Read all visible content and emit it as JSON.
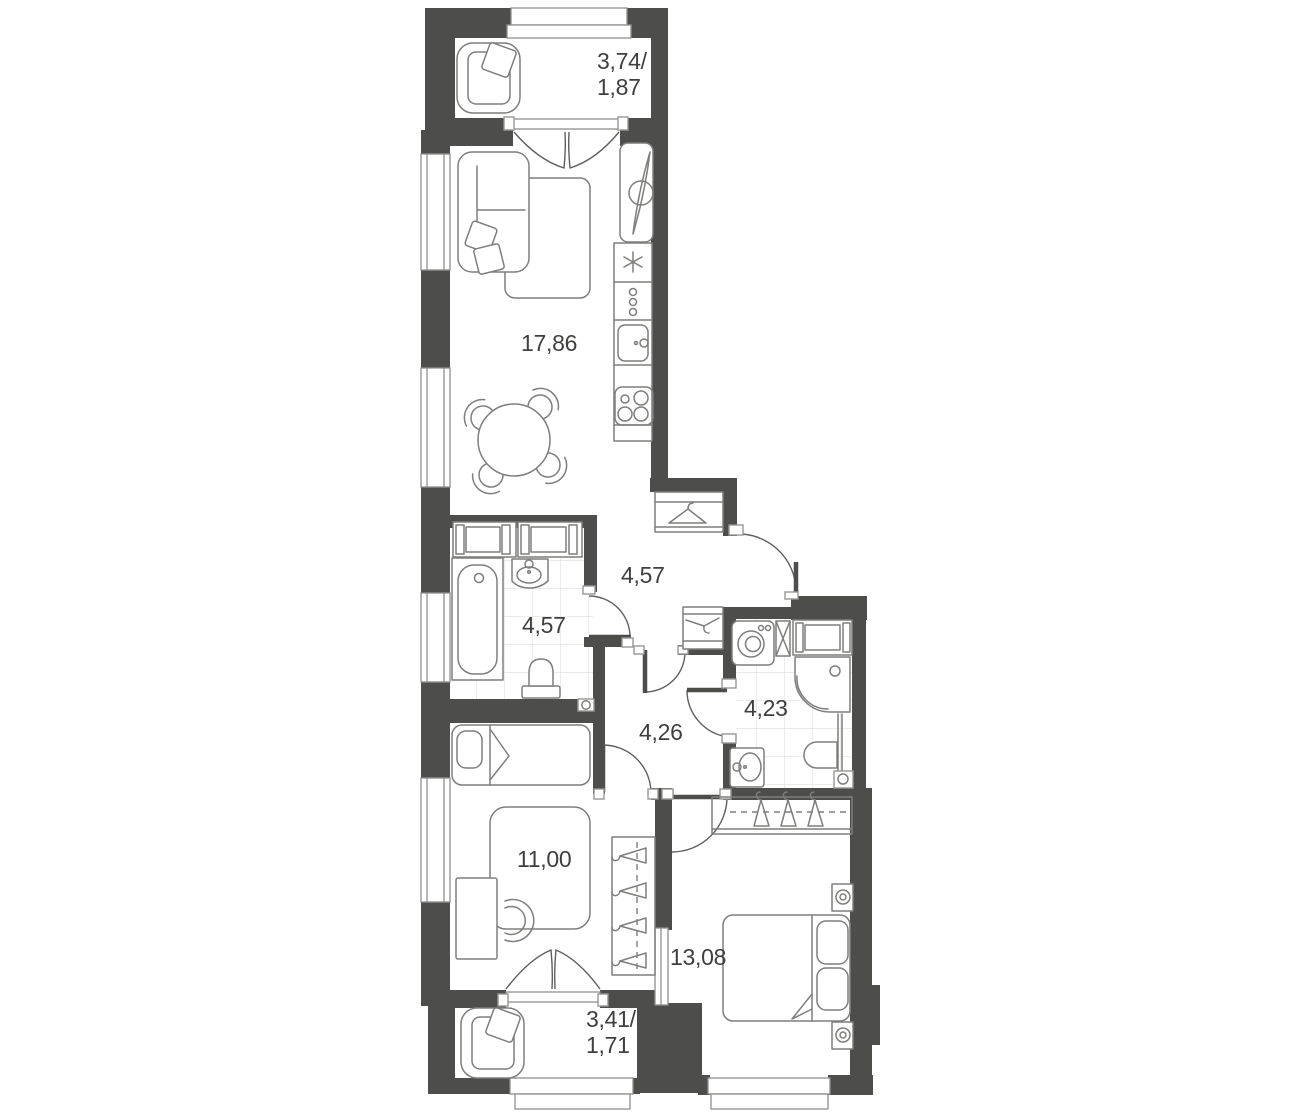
{
  "title": "Two-bedroom apartment floor plan",
  "colors": {
    "background": "#ffffff",
    "wall": "#4d4d4b",
    "furniture_line": "#7e7e7c",
    "door_line": "#5f5f5d",
    "tile_line": "#e0dfdd",
    "text": "#3f3f3d"
  },
  "rooms": [
    {
      "id": "balcony-top",
      "area": "3,74/\n1,87"
    },
    {
      "id": "living-kitchen",
      "area": "17,86"
    },
    {
      "id": "hallway",
      "area": "4,57"
    },
    {
      "id": "bathroom-main",
      "area": "4,57"
    },
    {
      "id": "inner-hall",
      "area": "4,26"
    },
    {
      "id": "bathroom-second",
      "area": "4,23"
    },
    {
      "id": "bedroom-small",
      "area": "11,00"
    },
    {
      "id": "bedroom-master",
      "area": "13,08"
    },
    {
      "id": "balcony-bottom",
      "area": "3,41/\n1,71"
    }
  ],
  "icons": {
    "armchair-icon": "rounded armchair with tilted cushion",
    "sofa-icon": "corner sofa with two loose cushions",
    "rug-icon": "rounded rectangle rug",
    "dining-table-icon": "round table with four chairs",
    "tv-unit-icon": "lens shaped TV on stand",
    "fridge-icon": "snowflake",
    "kitchen-cabinet-icon": "three knobs",
    "kitchen-sink-icon": "basin with tap",
    "stove-icon": "four burner rings",
    "wardrobe-cabinet-icon": "double cabinet with sliding doors",
    "bathtub-icon": "tub with drain",
    "washbasin-icon": "oval basin with tap",
    "toilet-icon": "bowl with cistern",
    "washing-machine-icon": "drum with porthole",
    "duct-icon": "crossed box",
    "shower-icon": "quarter-round tray with drain",
    "vent-icon": "small box with circle",
    "coat-hanger-icon": "clothes hanger",
    "hanger-rail-icon": "dashed rail with hangers",
    "single-bed-icon": "bed with one pillow",
    "double-bed-icon": "bed with two pillows and folded blanket",
    "nightstand-icon": "bedside table with lamp",
    "desk-icon": "desk with half-round chair",
    "window-icon": "triple-line glazing",
    "door-icon": "quarter-circle swing arc",
    "french-door-icon": "double leaf V symbol"
  }
}
